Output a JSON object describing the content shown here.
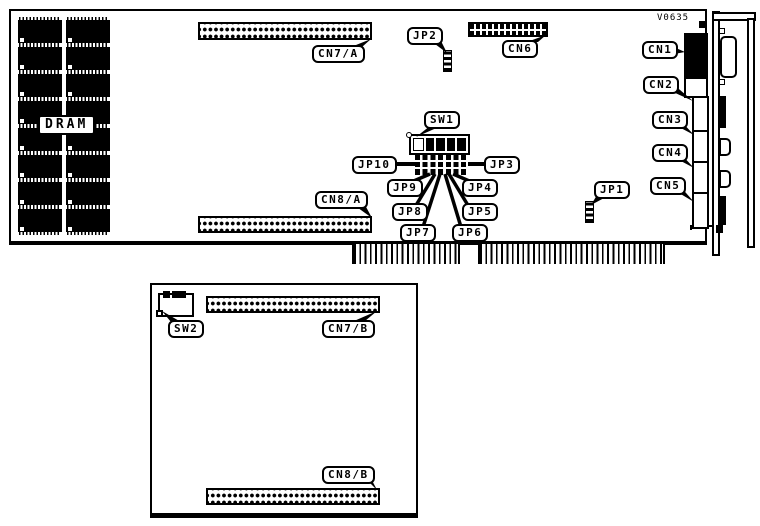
{
  "version": "V0635",
  "labels": {
    "dram": "DRAM",
    "cn7a": "CN7/A",
    "jp2": "JP2",
    "cn6": "CN6",
    "cn1": "CN1",
    "cn2": "CN2",
    "cn3": "CN3",
    "cn4": "CN4",
    "cn5": "CN5",
    "sw1": "SW1",
    "jp10": "JP10",
    "jp3": "JP3",
    "jp9": "JP9",
    "jp4": "JP4",
    "jp8": "JP8",
    "jp5": "JP5",
    "jp7": "JP7",
    "jp6": "JP6",
    "jp1": "JP1",
    "cn8a": "CN8/A",
    "sw2": "SW2",
    "cn7b": "CN7/B",
    "cn8b": "CN8/B"
  }
}
